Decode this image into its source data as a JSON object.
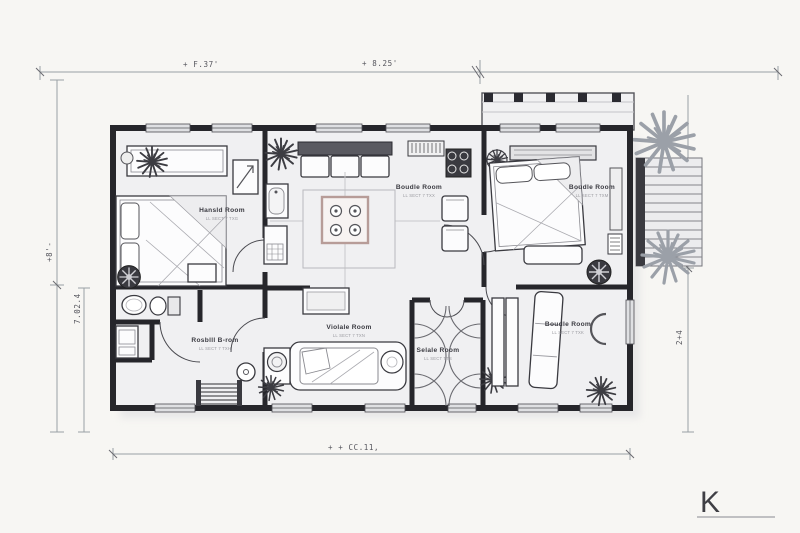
{
  "drawing": {
    "dimensions": {
      "top_left": "+ F.37'",
      "top_right": "+ 8.25'",
      "left_outer": "+8'-",
      "left_inner": "7.02.4",
      "right": "2+4",
      "bottom": "+ + CC.11,"
    },
    "rooms": {
      "bedroom_left": {
        "label": "Hansld Room",
        "sub": "LL SECT 7 TXG"
      },
      "living": {
        "label": "Boudle Room",
        "sub": "LL SECT 7 TXX"
      },
      "bedroom_right": {
        "label": "Boudle Room",
        "sub": "LL SECT 7 TXM"
      },
      "lounge": {
        "label": "Violale Room",
        "sub": "LL SECT 7 TXN"
      },
      "bath_small": {
        "label": "Selale Room",
        "sub": "LL SECT TTS"
      },
      "study_right": {
        "label": "Boudle Room",
        "sub": "LL SECT 7 TXK"
      },
      "hall_left": {
        "label": "Rosblll B-rom",
        "sub": "LL SECT 7 TXH"
      }
    },
    "logo": "K",
    "colors": {
      "wall": "#26262b",
      "paper": "#f7f6f3",
      "floor": "#f0f0f2",
      "island_accent": "#b79c98",
      "plant_dark": "#3c3c42",
      "plant_gray": "#9ba0a8"
    }
  }
}
